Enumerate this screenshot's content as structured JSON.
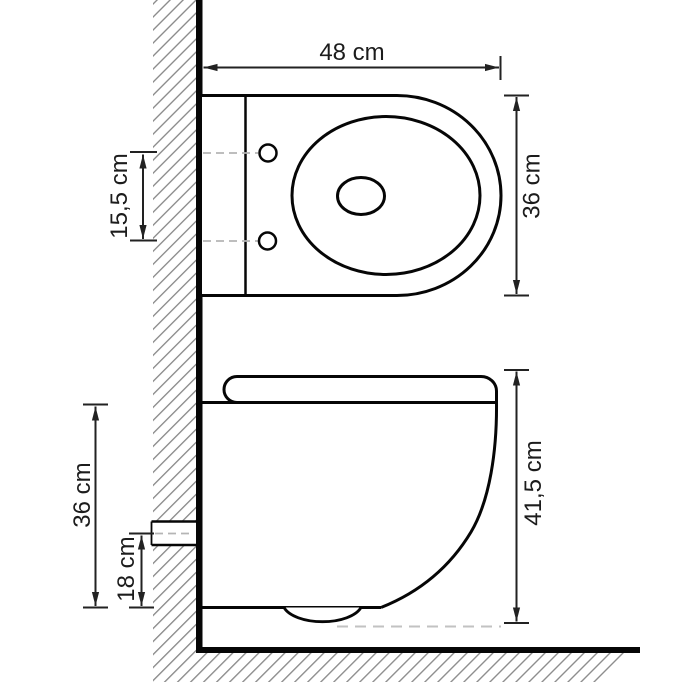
{
  "drawing": {
    "type": "technical-dimension-diagram",
    "subject": "wall-hung toilet, top view and side view against hatched wall and floor",
    "views": {
      "top": {
        "dimensions": {
          "width": {
            "label": "48 cm"
          },
          "depth": {
            "label": "36 cm"
          },
          "hole_spacing": {
            "label": "15,5 cm"
          }
        }
      },
      "side": {
        "dimensions": {
          "height": {
            "label": "41,5 cm"
          },
          "seat_to_bottom": {
            "label": "36 cm"
          },
          "outlet_to_bottom": {
            "label": "18 cm"
          }
        }
      }
    },
    "colors": {
      "background": "#ffffff",
      "outline": "#060606",
      "dimension_line": "#222222",
      "hatch": "#8a8a8a",
      "dashed_centerline": "#b5b5b5"
    }
  }
}
